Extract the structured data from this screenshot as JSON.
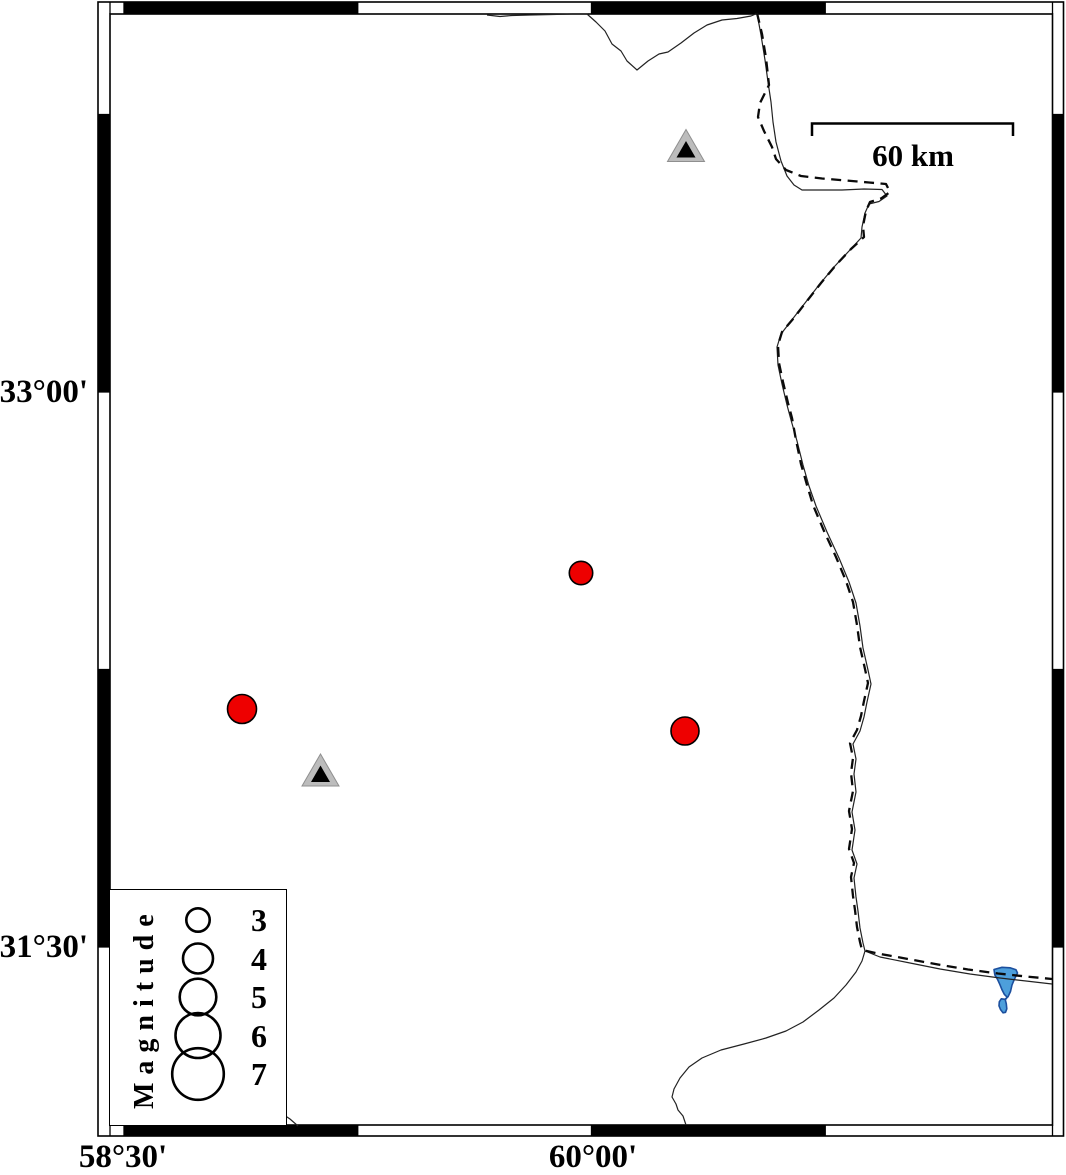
{
  "figure": {
    "axis": {
      "left_labels": [
        {
          "text": "33°00'",
          "y": 392
        },
        {
          "text": "31°30'",
          "y": 947
        }
      ],
      "bottom_labels": [
        {
          "text": "58°30'",
          "x": 123
        },
        {
          "text": "60°00'",
          "x": 593
        }
      ]
    },
    "scale_bar": {
      "label": "60 km"
    },
    "legend": {
      "title": "Magnitude",
      "entries": [
        {
          "label": "3",
          "r": 11.7
        },
        {
          "label": "4",
          "r": 15
        },
        {
          "label": "5",
          "r": 18.3
        },
        {
          "label": "6",
          "r": 22.5
        },
        {
          "label": "7",
          "r": 25.8
        }
      ]
    },
    "earthquakes": [
      {
        "x": 581,
        "y": 573,
        "r": 11.7,
        "magnitude": 3
      },
      {
        "x": 242,
        "y": 709,
        "r": 14.5,
        "magnitude": 4
      },
      {
        "x": 685,
        "y": 731,
        "r": 14,
        "magnitude": 4
      }
    ],
    "stations": [
      {
        "x": 686,
        "y": 146
      },
      {
        "x": 320.5,
        "y": 770.5
      }
    ],
    "colors": {
      "earthquake_fill": "#ee0000",
      "marker_outline": "#000000",
      "station_fill": "#bcbcbc",
      "station_outline": "#8f8f8f",
      "station_inner": "#000000",
      "lake_fill": "#4d9fdb",
      "lake_outline": "#1c4f9e"
    }
  }
}
